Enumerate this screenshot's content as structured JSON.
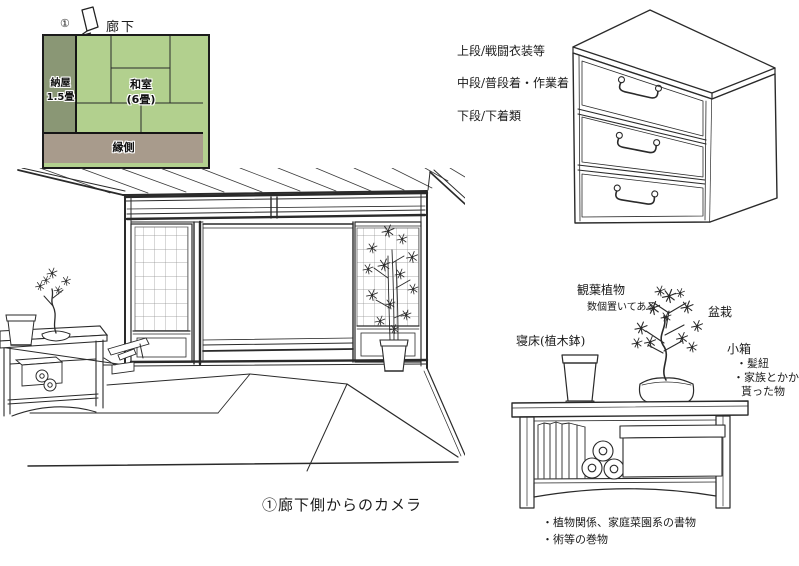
{
  "floor_plan": {
    "corridor_label": "廊下",
    "camera_marker": "①",
    "naya_label": "納屋",
    "naya_size": "1.5畳",
    "washitsu_label": "和室",
    "washitsu_size": "(6畳)",
    "engawa_label": "縁側",
    "colors": {
      "naya": "#8a9775",
      "washitsu": "#b2d08e",
      "engawa": "#a89b8c",
      "border": "#1c1c1c"
    }
  },
  "chest": {
    "labels": [
      "上段/戦闘衣装等",
      "中段/普段着・作業着",
      "下段/下着類"
    ]
  },
  "caption": "①廊下側からのカメラ",
  "shelf_detail": {
    "foliage_plant": "観葉植物",
    "foliage_note": "数個置いてある",
    "bonsai": "盆栽",
    "bed_pot": "寝床(植木鉢)",
    "small_box": "小箱",
    "small_box_items": [
      "・髪紐",
      "・家族とかから",
      "貰った物"
    ],
    "bottom_notes": [
      "・植物関係、家庭菜園系の書物",
      "・術等の巻物"
    ]
  }
}
